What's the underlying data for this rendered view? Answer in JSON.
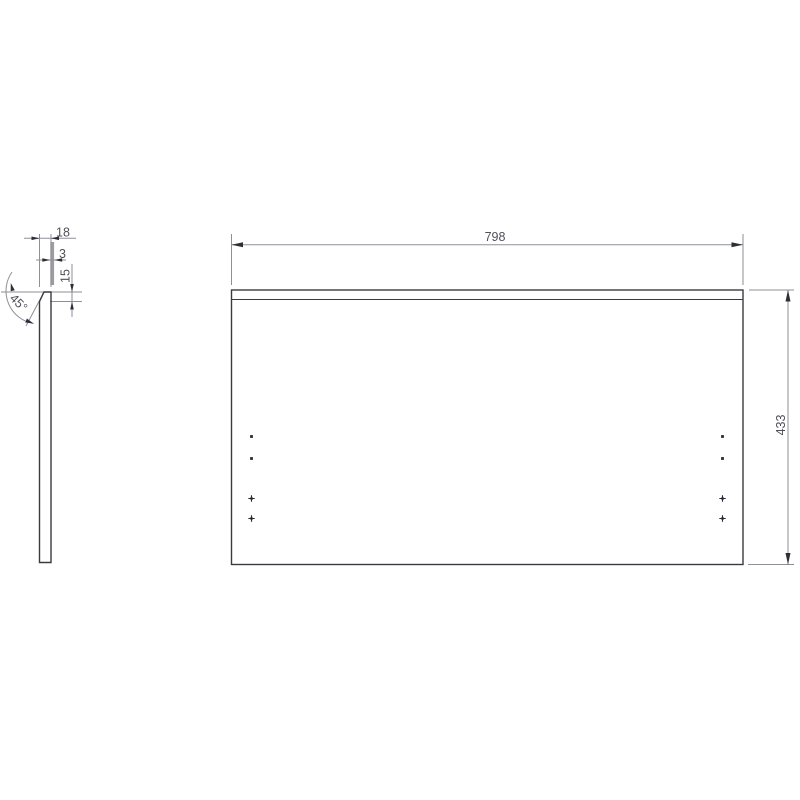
{
  "drawing": {
    "type": "technical-drawing",
    "views": {
      "side_view": {
        "label": "panel-edge-profile",
        "dims": {
          "thickness": "18",
          "back_panel_thickness": "3",
          "chamfer_height": "15",
          "chamfer_angle": "45°"
        }
      },
      "front_view": {
        "label": "panel-front",
        "dims": {
          "width": "798",
          "height": "433"
        }
      }
    },
    "colors": {
      "background": "#ffffff",
      "geometry_line": "#3a3a42",
      "dimension_line": "#8f8f97",
      "arrowhead": "#2e2e36",
      "dimension_text": "#50505a",
      "highlight_bar": "#9c9ca4",
      "hole_mark": "#2a2a32"
    }
  }
}
